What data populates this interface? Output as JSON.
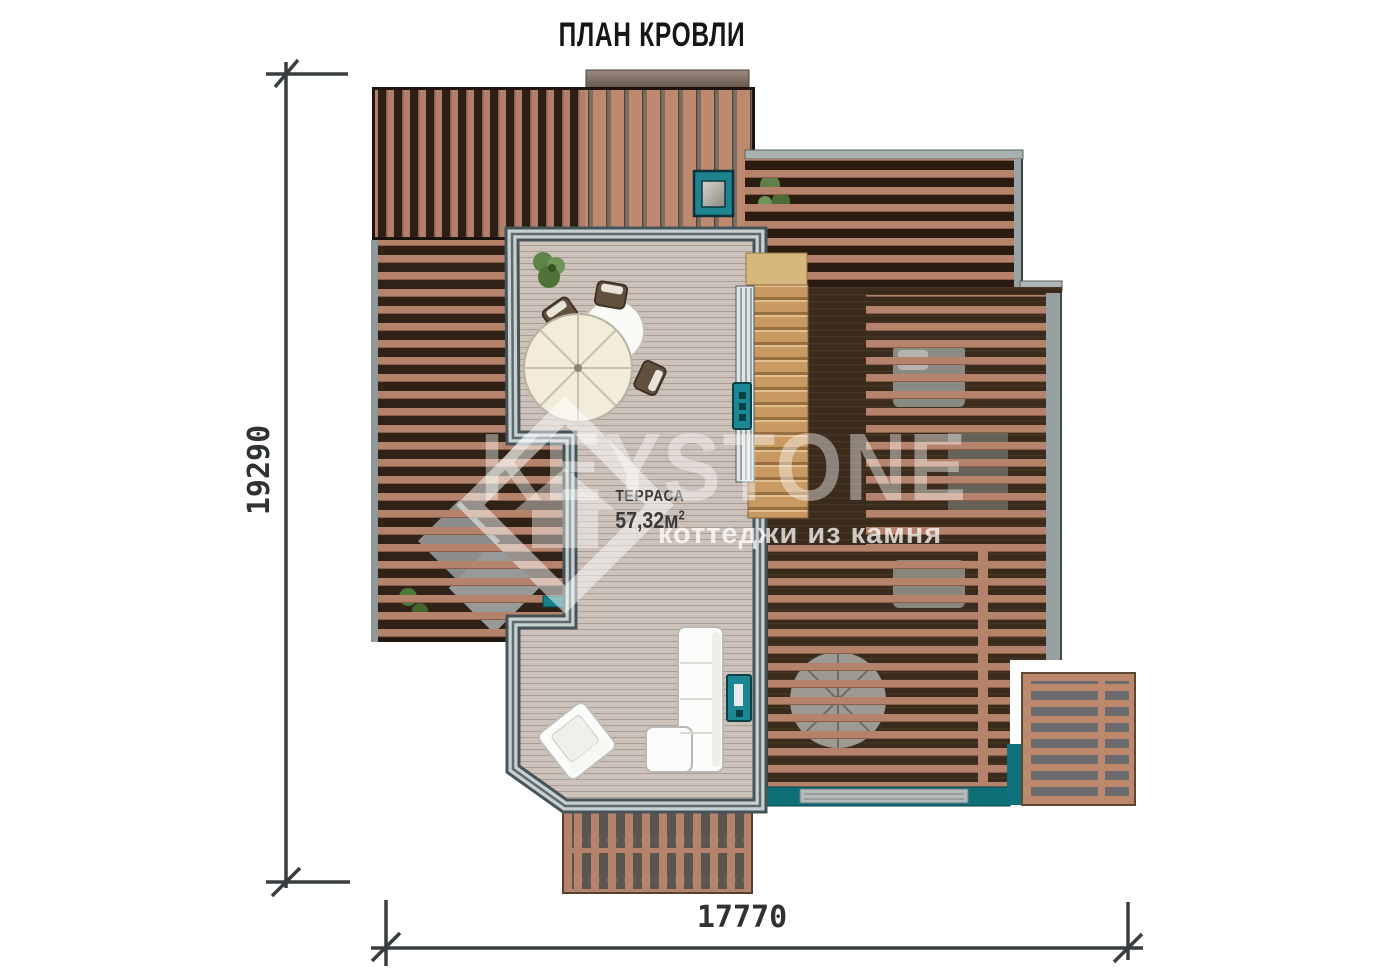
{
  "title": "ПЛАН КРОВЛИ",
  "dimensions": {
    "left": "19290",
    "bottom": "17770"
  },
  "terrace": {
    "name": "ТЕРРАСА",
    "area_value": "57,32м",
    "area_sup": "2"
  },
  "watermark": {
    "brand": "KEYSTONE",
    "tagline": "коттеджи из камня"
  },
  "colors": {
    "accent_teal": "#1b8894",
    "pool_teal": "#0e6f79",
    "slat_salmon": "#b5836c",
    "roof_dark": "#33241a",
    "deck": "#cdc2ba",
    "stairs_wood": "#c89a62",
    "frame_gray": "#c8d1d1"
  }
}
